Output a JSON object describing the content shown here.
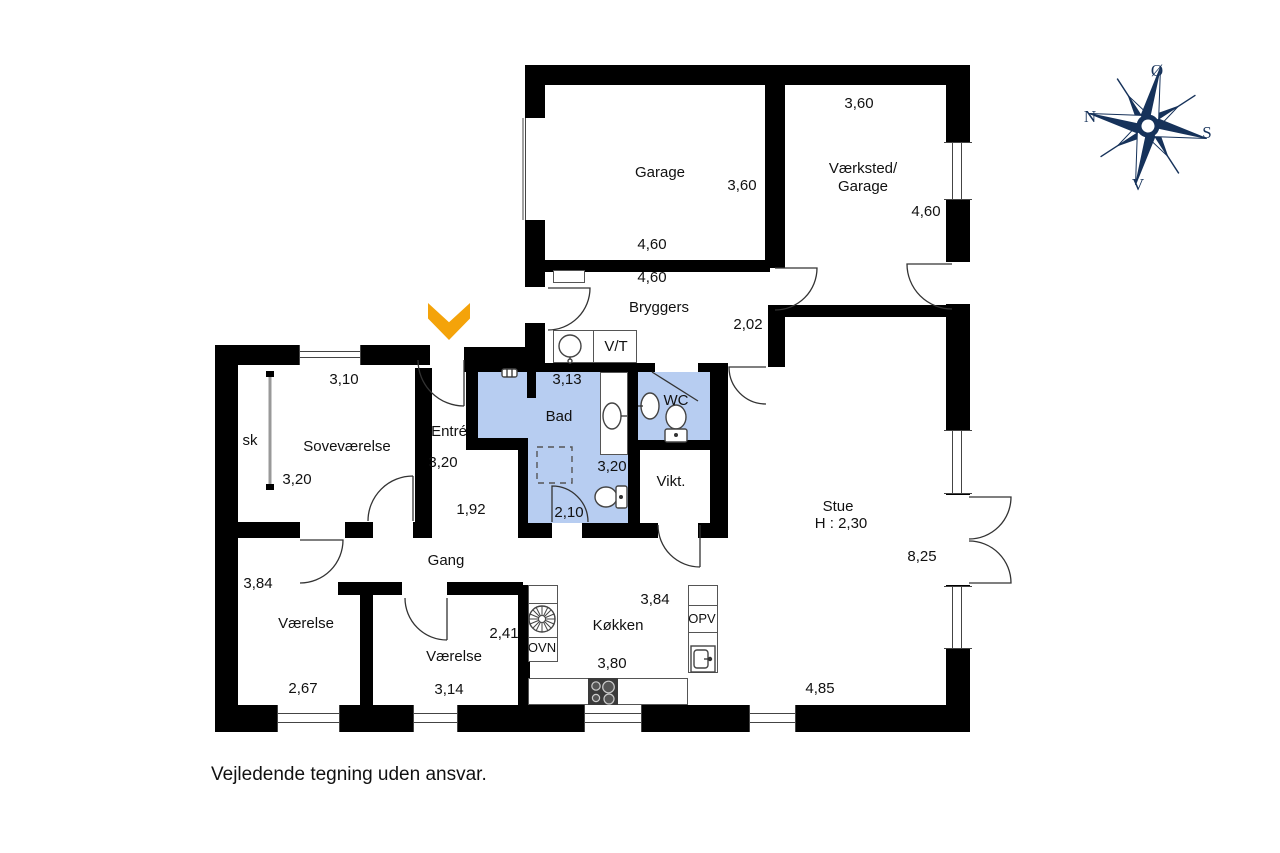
{
  "title": "Floor plan",
  "disclaimer": "Vejledende tegning uden ansvar.",
  "colors": {
    "wall": "#000000",
    "room_blue": "#b7cdf1",
    "arrow": "#f4a30a",
    "compass": "#16325a",
    "text": "#111111"
  },
  "compass": {
    "east": "Ø",
    "north": "N",
    "south": "S",
    "west": "V"
  },
  "rooms": {
    "garage": {
      "name": "Garage",
      "dim_width": "3,60",
      "dim_depth": "4,60"
    },
    "vaerksted": {
      "name_line1": "Værksted/",
      "name_line2": "Garage",
      "dim_top": "3,60",
      "dim_right": "4,60"
    },
    "bryggers": {
      "name": "Bryggers",
      "dim_top": "4,60",
      "dim_passage": "2,02"
    },
    "vt_niche": {
      "label": "V/T"
    },
    "bad": {
      "name": "Bad",
      "dim_top": "3,13",
      "dim_right": "3,20",
      "dim_bottom": "2,10"
    },
    "wc": {
      "name": "WC"
    },
    "vikt": {
      "name": "Vikt."
    },
    "entre": {
      "name": "Entré",
      "dim": "3,20",
      "dim_passage": "1,92"
    },
    "closet": {
      "label": "sk"
    },
    "sovevaerelse": {
      "name": "Soveværelse",
      "dim_top": "3,10",
      "dim": "3,20"
    },
    "stue": {
      "name": "Stue",
      "ceiling_height": "H : 2,30",
      "dim_right": "8,25",
      "dim_bottom": "4,85"
    },
    "gang": {
      "name": "Gang"
    },
    "vaerelse1": {
      "name": "Værelse",
      "dim_left": "3,84",
      "dim_bottom": "2,67"
    },
    "vaerelse2": {
      "name": "Værelse",
      "dim_right": "2,41",
      "dim_bottom": "3,14"
    },
    "koekken": {
      "name": "Køkken",
      "dim_top": "3,84",
      "dim_bottom": "3,80",
      "oven_label": "OVN",
      "dishwasher_label": "OPV"
    }
  },
  "icons": {
    "entrance-arrow": "chevron-down",
    "compass-rose": "8-point-star",
    "washing-machine": "circle-drum",
    "extractor-fan": "spoked-circle",
    "cooktop": "4-burners",
    "toilet": "bowl-with-tank",
    "sink": "oval-basin",
    "shower": "dashed-square"
  }
}
